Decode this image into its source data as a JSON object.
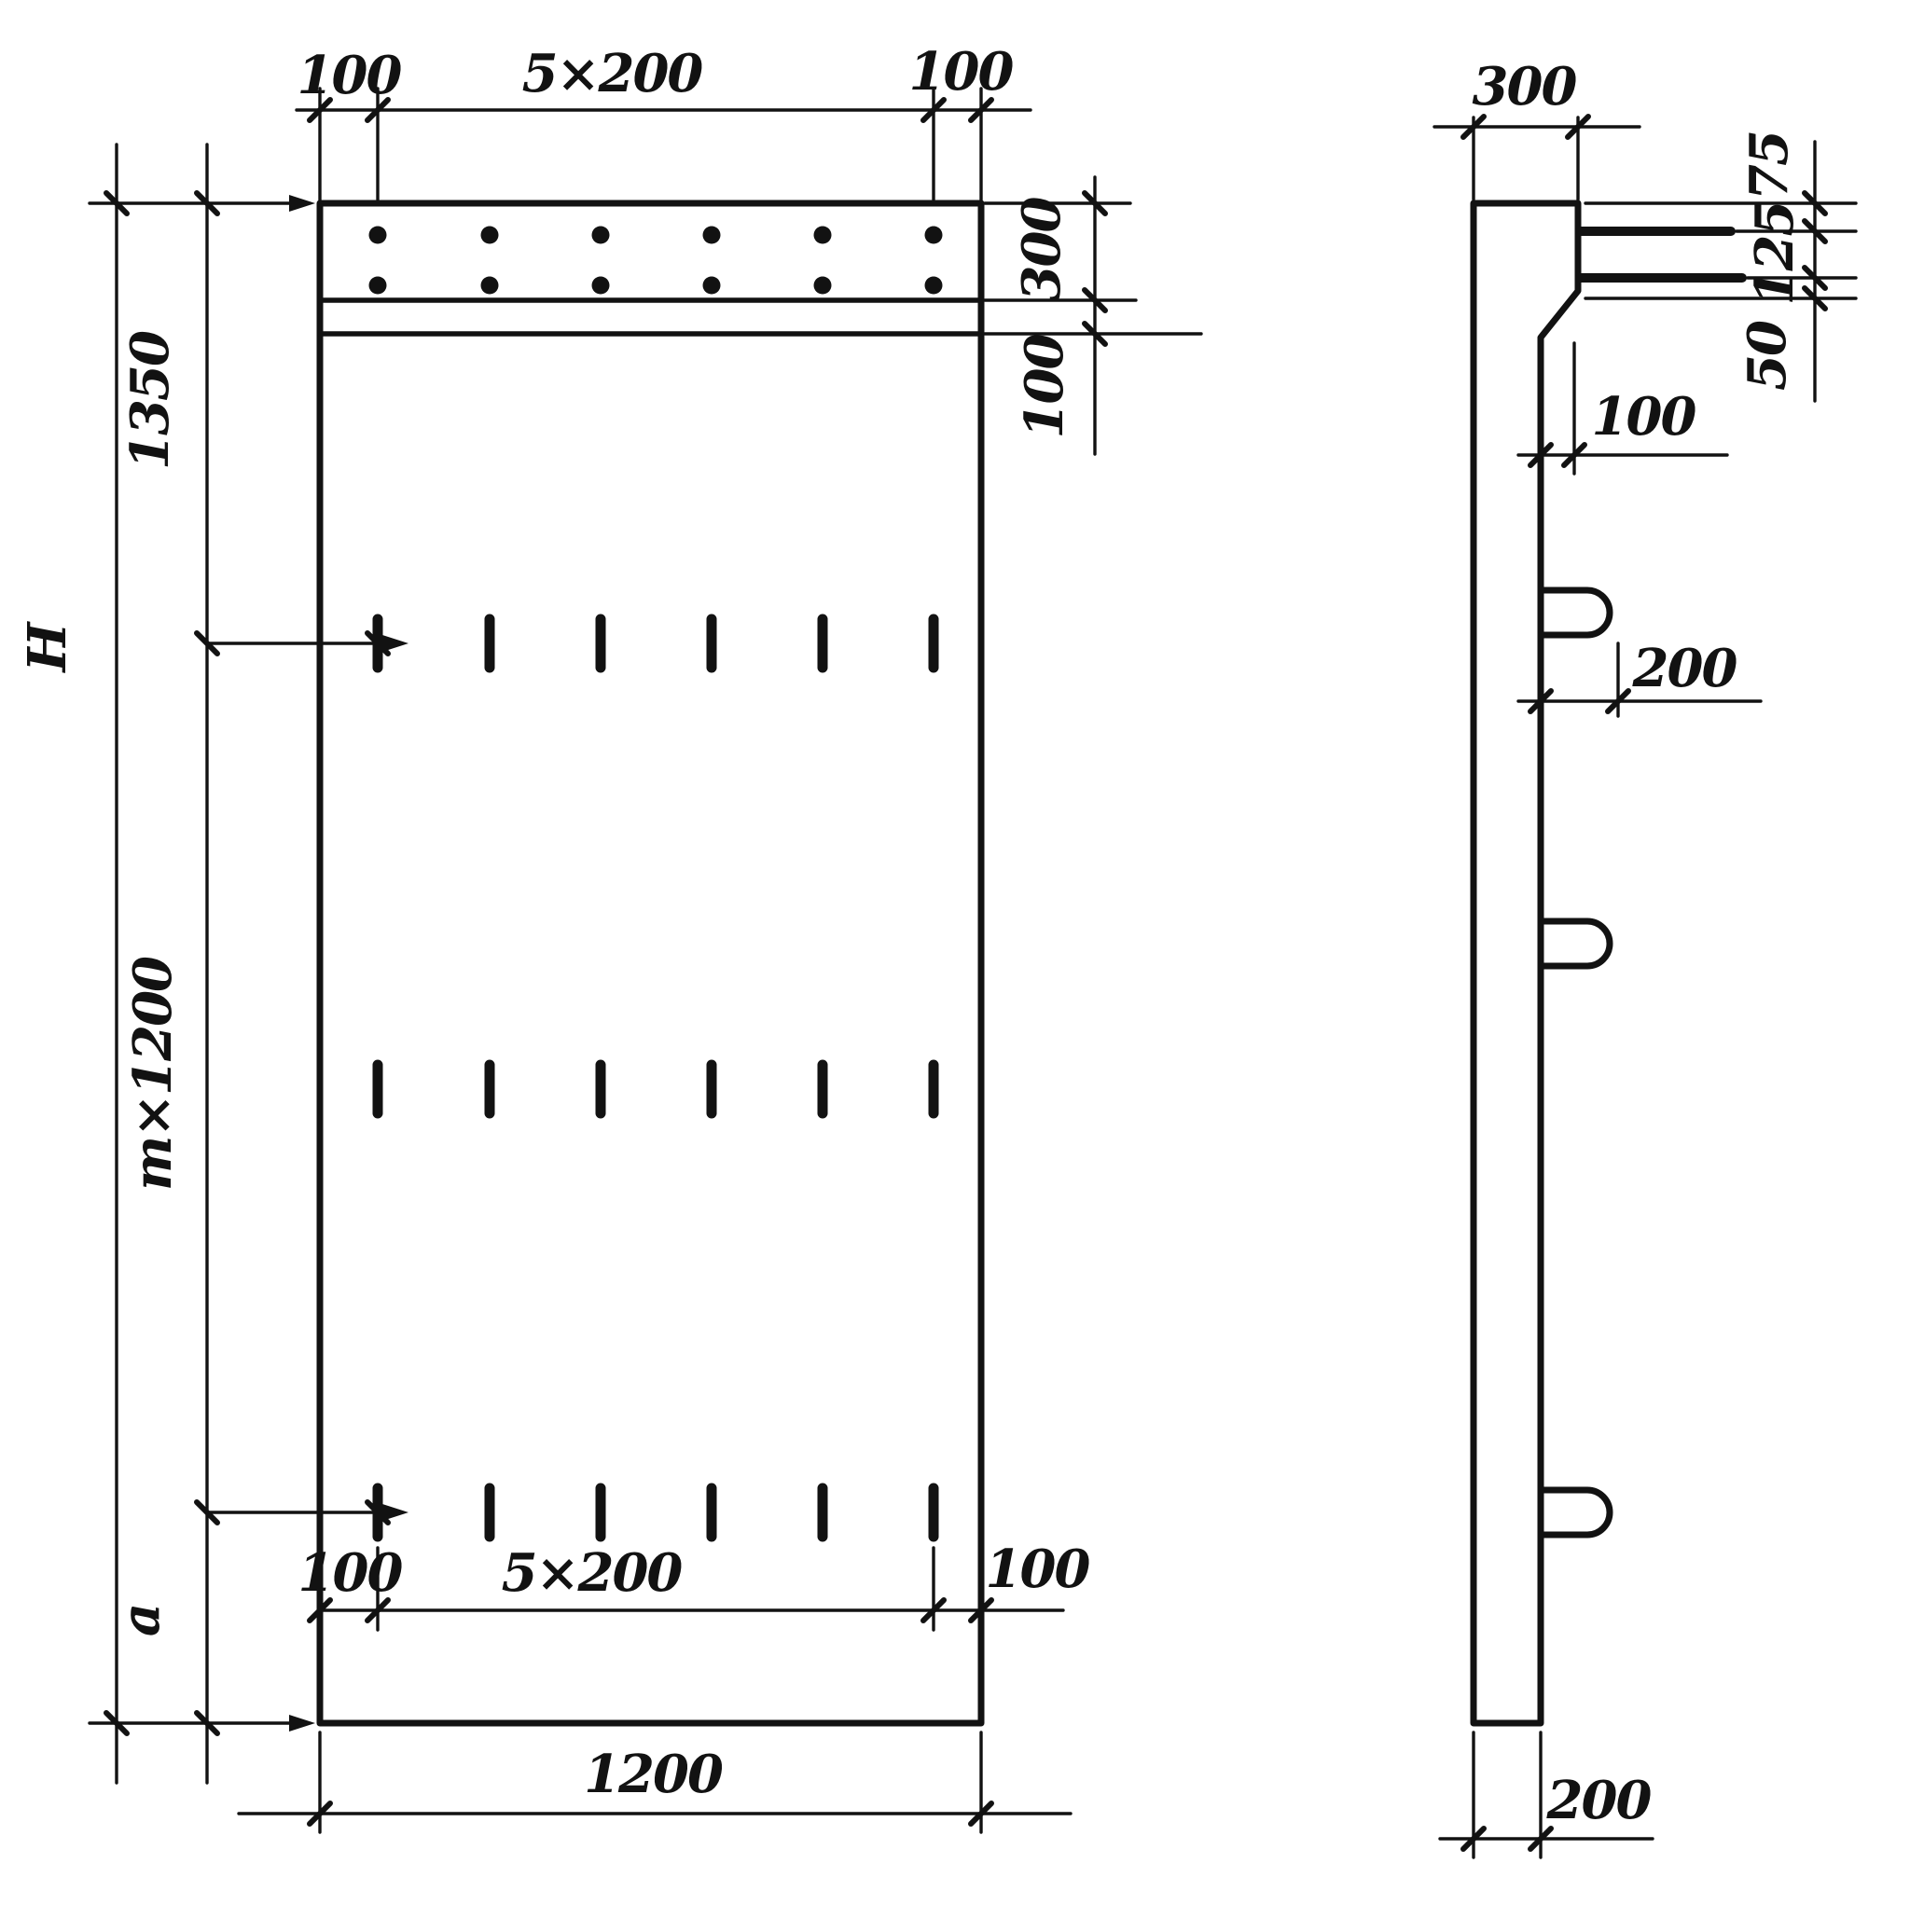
{
  "front_view": {
    "top_chain": {
      "left_margin": "100",
      "spacing": "5×200",
      "right_margin": "100"
    },
    "right_chain": {
      "band_height": "300",
      "lip_height": "100"
    },
    "left_chain": {
      "overall_height": "H",
      "top_segment": "1350",
      "middle_segment": "m×1200",
      "bottom_segment": "a"
    },
    "bottom_chain": {
      "left_margin": "100",
      "spacing": "5×200",
      "right_margin": "100"
    },
    "overall_width": "1200"
  },
  "side_view": {
    "top_width": "300",
    "right_chain": {
      "top_offset": "75",
      "bar_spacing": "125",
      "bottom_offset": "50"
    },
    "step_depth": "100",
    "loop_length": "200",
    "bottom_width": "200"
  }
}
